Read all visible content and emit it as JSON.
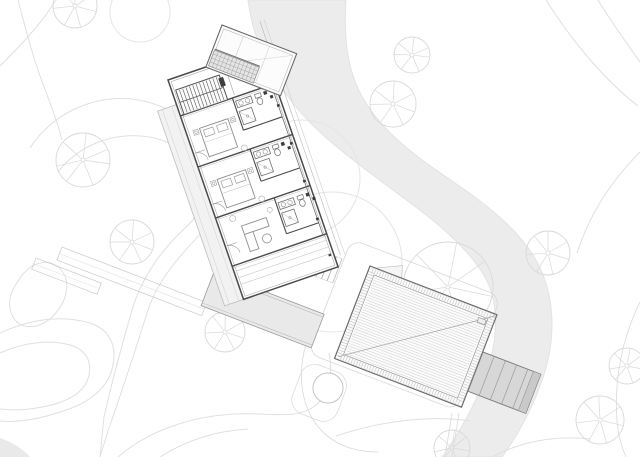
{
  "meta": {
    "title": "Architectural site plan — hillside house with detached timber deck",
    "drawing_type": "CAD plan drawing, grayscale linework on white"
  },
  "palette": {
    "background": "#ffffff",
    "stream_fill": "#ececec",
    "stream_edge": "#e3e3e3",
    "contour": "#e0e0e0",
    "tree": "#d9d9d9",
    "canopy": "#e5e5e5",
    "faint_path": "#d8d8d8",
    "wall_dark": "#4a4a4a",
    "wall_mid": "#8a8a8a",
    "furniture": "#8f8f8f",
    "hatch": "#c8c8c8",
    "deck_fill": "#fcfcfc",
    "stair_fill": "#d7d7d7",
    "terrace_fill": "#e9e9e9",
    "west_deck_fill": "#f2f2f2",
    "grid_fill": "#e4e4e4",
    "column_dark": "#3a3a3a",
    "corner_shade": "#e9e9e9"
  },
  "stream": {
    "path": "M 248 0 C 252 34 266 68 292 102 C 316 133 348 156 382 182 C 420 210 458 236 482 272 C 500 300 498 336 488 368 C 477 402 460 432 442 457 L 502 457 C 520 432 536 402 546 368 C 556 332 554 292 536 260 C 514 222 474 196 436 170 C 400 145 370 118 356 84 C 346 60 344 30 346 0 Z"
  },
  "contours": {
    "paths": [
      "M 18 0 C 26 30 34 62 46 92 C 52 108 58 124 62 140",
      "M 30 148 C 52 114 92 95 132 99 C 172 104 204 129 221 161 C 232 181 228 204 210 224 C 185 250 160 275 148 310 C 136 348 122 391 108 431 L 100 457",
      "M 58 172 C 78 146 113 131 149 137 C 179 142 197 161 203 182 C 208 200 198 217 182 231 C 160 252 142 277 132 310 C 122 345 112 381 104 417 L 100 457",
      "M 17 283 C 28 262 50 255 62 271 C 71 283 67 302 53 316 C 40 329 21 331 13 317 C 7 306 9 294 17 283 Z",
      "M 0 333 C 28 320 60 314 90 323 C 109 329 117 345 113 365 C 109 387 91 401 69 409 C 45 418 19 423 0 421",
      "M 0 353 C 22 343 48 339 70 345 C 86 350 92 361 89 375 C 86 390 72 399 55 404 C 37 409 17 411 0 409",
      "M 118 457 C 148 431 189 417 233 414 C 268 412 297 421 316 405 C 330 393 333 373 329 353",
      "M 160 457 C 185 441 215 431 248 429",
      "M 0 66 C 22 44 42 23 56 0",
      "M 546 0 C 570 38 602 78 638 106",
      "M 598 0 C 614 26 630 48 640 62",
      "M 640 152 C 610 182 589 216 577 253",
      "M 640 302 C 622 339 614 379 617 421 C 618 434 621 446 626 457",
      "M 492 457 C 520 442 554 435 590 439",
      "M 336 436 C 380 421 430 415 470 421",
      "M 452 413 L 445 457",
      "M 459 413 L 452 457"
    ],
    "corner_shade_path": "M 0 438 C 12 442 23 449 30 457 L 0 457 Z"
  },
  "vegetation": {
    "canopies": [
      {
        "cx": 302,
        "cy": 178,
        "r": 58
      },
      {
        "cx": 332,
        "cy": 262,
        "r": 70
      },
      {
        "cx": 140,
        "cy": 12,
        "r": 30
      }
    ],
    "trees": [
      {
        "cx": 412,
        "cy": 55,
        "r": 18
      },
      {
        "cx": 393,
        "cy": 104,
        "r": 23
      },
      {
        "cx": 548,
        "cy": 253,
        "r": 22
      },
      {
        "cx": 600,
        "cy": 420,
        "r": 24
      },
      {
        "cx": 627,
        "cy": 366,
        "r": 18
      },
      {
        "cx": 83,
        "cy": 160,
        "r": 27
      },
      {
        "cx": 132,
        "cy": 242,
        "r": 22
      },
      {
        "cx": 225,
        "cy": 332,
        "r": 20
      },
      {
        "cx": 75,
        "cy": 6,
        "r": 22
      },
      {
        "cx": 448,
        "cy": 287,
        "r": 45
      },
      {
        "cx": 452,
        "cy": 448,
        "r": 18
      }
    ],
    "spoke_angles": [
      15,
      70,
      125,
      175,
      225,
      275,
      330
    ]
  },
  "site": {
    "deck_outline": {
      "origin": [
        355,
        247
      ],
      "rotation": 21,
      "x": -6,
      "y": -6,
      "w": 160,
      "h": 122,
      "rx": 12
    },
    "walkways": [
      {
        "origin": [
          62,
          247
        ],
        "rotation": 21,
        "w": 155,
        "h": 14
      },
      {
        "origin": [
          36,
          258
        ],
        "rotation": 21,
        "w": 70,
        "h": 12
      }
    ],
    "steps": {
      "origin": [
        314,
        248
      ],
      "rotation": 21,
      "count": 6,
      "gap": 6,
      "len": 26
    },
    "circle": {
      "cx": 328,
      "cy": 388,
      "r": 15
    },
    "circle_surround": {
      "origin": [
        306,
        360
      ],
      "rotation": 21,
      "w": 48,
      "h": 52,
      "rx": 15
    },
    "boundary_path": "M 306 344 C 298 372 300 402 316 424 C 330 443 352 452 378 452"
  },
  "terrace": {
    "origin": [
      214,
      272
    ],
    "rotation": 21,
    "w": 118,
    "h": 36
  },
  "deck": {
    "origin": [
      370,
      266
    ],
    "rotation": 21,
    "w": 136,
    "h": 99,
    "hatch_step": 2.6,
    "corner_detail": {
      "x": 120,
      "y": 9,
      "w": 8,
      "h": 5
    },
    "flag_points": "6,0 30,-12 34,0"
  },
  "deck_stair": {
    "origin": [
      483,
      352
    ],
    "rotation": 21,
    "w": 62,
    "h": 42,
    "tread_xs": [
      12,
      24,
      36,
      48
    ]
  },
  "house": {
    "origin": [
      168,
      80
    ],
    "rotation": -19,
    "w": 100,
    "h": 232,
    "row_walls": [
      38,
      92,
      146,
      197
    ],
    "west_deck": {
      "x": -20,
      "y": 26,
      "w": 20,
      "h": 206
    },
    "overhang_xs": [
      106,
      110.5
    ],
    "stair": {
      "x": 4,
      "y": 12,
      "w": 46,
      "h": 26,
      "treads": 12
    },
    "gallery_x": 96,
    "columns_y": [
      20,
      60,
      100,
      140,
      180,
      218
    ],
    "beds": [
      {
        "x": 14,
        "y": 56
      },
      {
        "x": 14,
        "y": 110
      }
    ],
    "baths": [
      {
        "wallTop": 38,
        "fx": 57,
        "fy": 40
      },
      {
        "wallTop": 92,
        "fx": 57,
        "fy": 94
      }
    ],
    "bath3": {
      "vx": 62,
      "top": 146,
      "bottom": 184,
      "fx": 64,
      "fy": 150
    },
    "sofa": {
      "x": 22,
      "y": 162
    },
    "table": {
      "cx": 42,
      "cy": 182,
      "r": 4.5
    },
    "stools": [
      {
        "cx": 16,
        "cy": 152,
        "r": 3
      },
      {
        "cx": 54,
        "cy": 156,
        "r": 2.5
      },
      {
        "cx": 50,
        "cy": 89,
        "r": 3
      },
      {
        "cx": 50,
        "cy": 143,
        "r": 3
      }
    ],
    "door_arcs": [
      [
        0,
        78
      ],
      [
        0,
        132
      ],
      [
        0,
        176
      ]
    ],
    "porch_lines": [
      203,
      210,
      217
    ]
  },
  "wing": {
    "origin": [
      222,
      25
    ],
    "rotation": 21,
    "w": 80,
    "h": 45,
    "ridge_xs": [
      24,
      52
    ],
    "grid": {
      "x": 2,
      "y": 26,
      "w": 48,
      "h": 17,
      "cols": 12,
      "rows": 4
    }
  }
}
